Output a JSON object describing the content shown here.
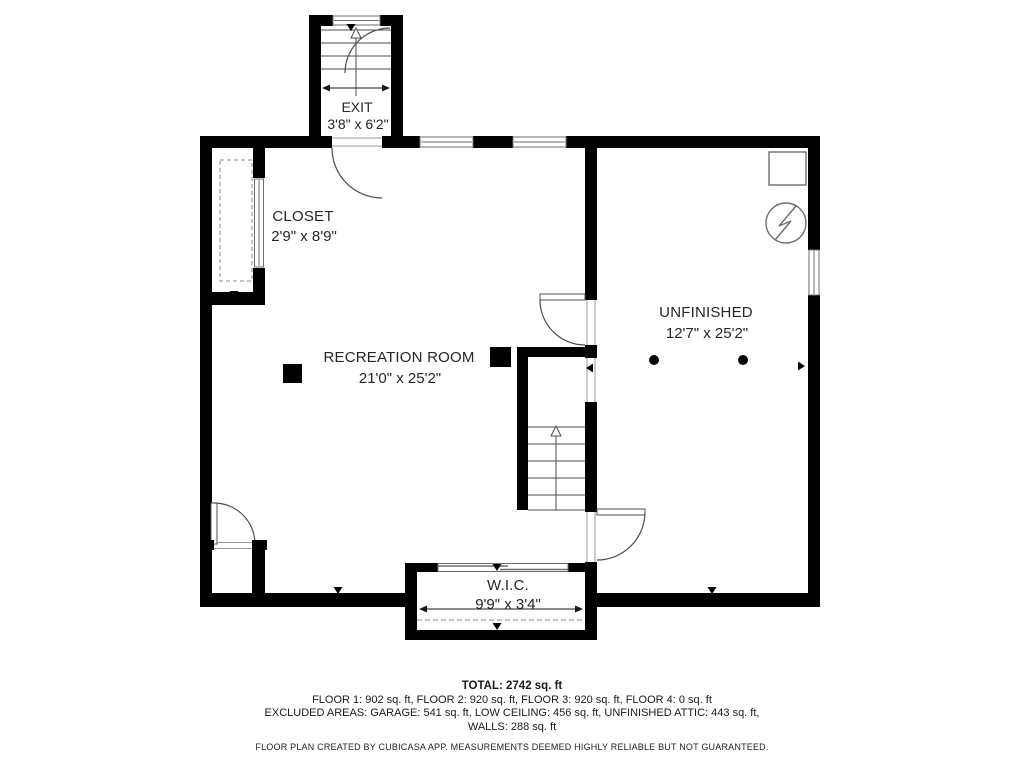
{
  "rooms": {
    "exit": {
      "name": "EXIT",
      "dims": "3'8\" x 6'2\""
    },
    "closet": {
      "name": "CLOSET",
      "dims": "2'9\" x 8'9\""
    },
    "recreation": {
      "name": "RECREATION ROOM",
      "dims": "21'0\" x 25'2\""
    },
    "unfinished": {
      "name": "UNFINISHED",
      "dims": "12'7\" x 25'2\""
    },
    "wic": {
      "name": "W.I.C.",
      "dims": "9'9\" x 3'4\""
    }
  },
  "summary": {
    "total": "TOTAL: 2742 sq. ft",
    "floors": "FLOOR 1: 902 sq. ft, FLOOR 2: 920 sq. ft, FLOOR 3: 920 sq. ft, FLOOR 4: 0 sq. ft",
    "excluded": "EXCLUDED AREAS: GARAGE: 541 sq. ft, LOW CEILING: 456 sq. ft, UNFINISHED ATTIC: 443 sq. ft,",
    "walls": "WALLS: 288 sq. ft",
    "disclaimer": "FLOOR PLAN CREATED BY CUBICASA APP. MEASUREMENTS DEEMED HIGHLY RELIABLE BUT NOT GUARANTEED."
  },
  "colors": {
    "wall": "#000000",
    "line": "#4d4d4d",
    "background": "#ffffff"
  }
}
